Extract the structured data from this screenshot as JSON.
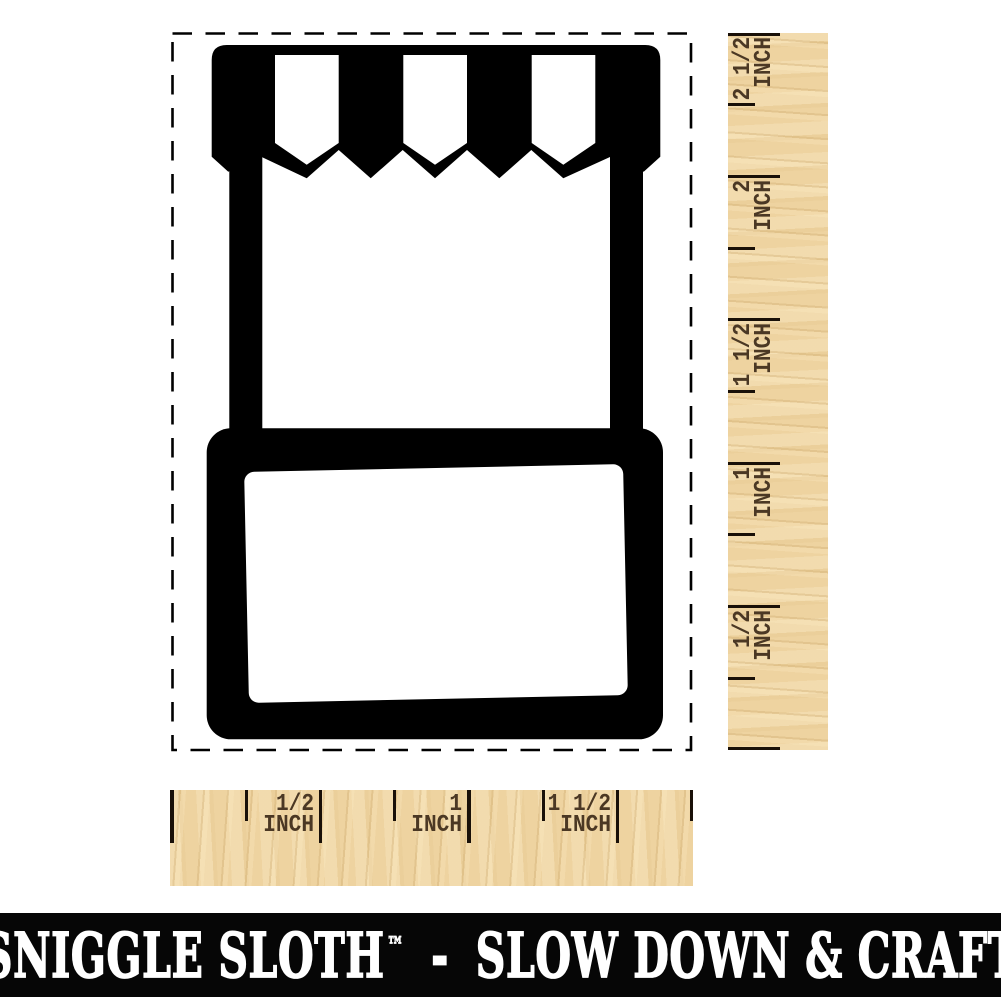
{
  "stamp_preview": {
    "icon_name": "market-stand-stamp",
    "stamp_color": "#000000",
    "outline_style": "dashed-cut-line"
  },
  "vertical_ruler": {
    "unit": "INCH",
    "marks": [
      {
        "inches": 0.5,
        "label": "1/2"
      },
      {
        "inches": 1,
        "label": "1"
      },
      {
        "inches": 1.5,
        "label": "1 1/2"
      },
      {
        "inches": 2,
        "label": "2"
      },
      {
        "inches": 2.5,
        "label": "2 1/2"
      }
    ]
  },
  "horizontal_ruler": {
    "unit": "INCH",
    "marks": [
      {
        "inches": 0.5,
        "label": "1/2"
      },
      {
        "inches": 1,
        "label": "1"
      },
      {
        "inches": 1.5,
        "label": "1 1/2"
      }
    ]
  },
  "footer": {
    "brand": "SNIGGLE SLOTH",
    "trademark": "™",
    "separator": "-",
    "tagline": "SLOW DOWN & CRAFT",
    "bg_color": "#060606",
    "text_color": "#ffffff"
  },
  "colors": {
    "wood": "#eed3a0",
    "tick": "#191008",
    "ruler_text": "#4b3824",
    "stamp_black": "#000000"
  }
}
